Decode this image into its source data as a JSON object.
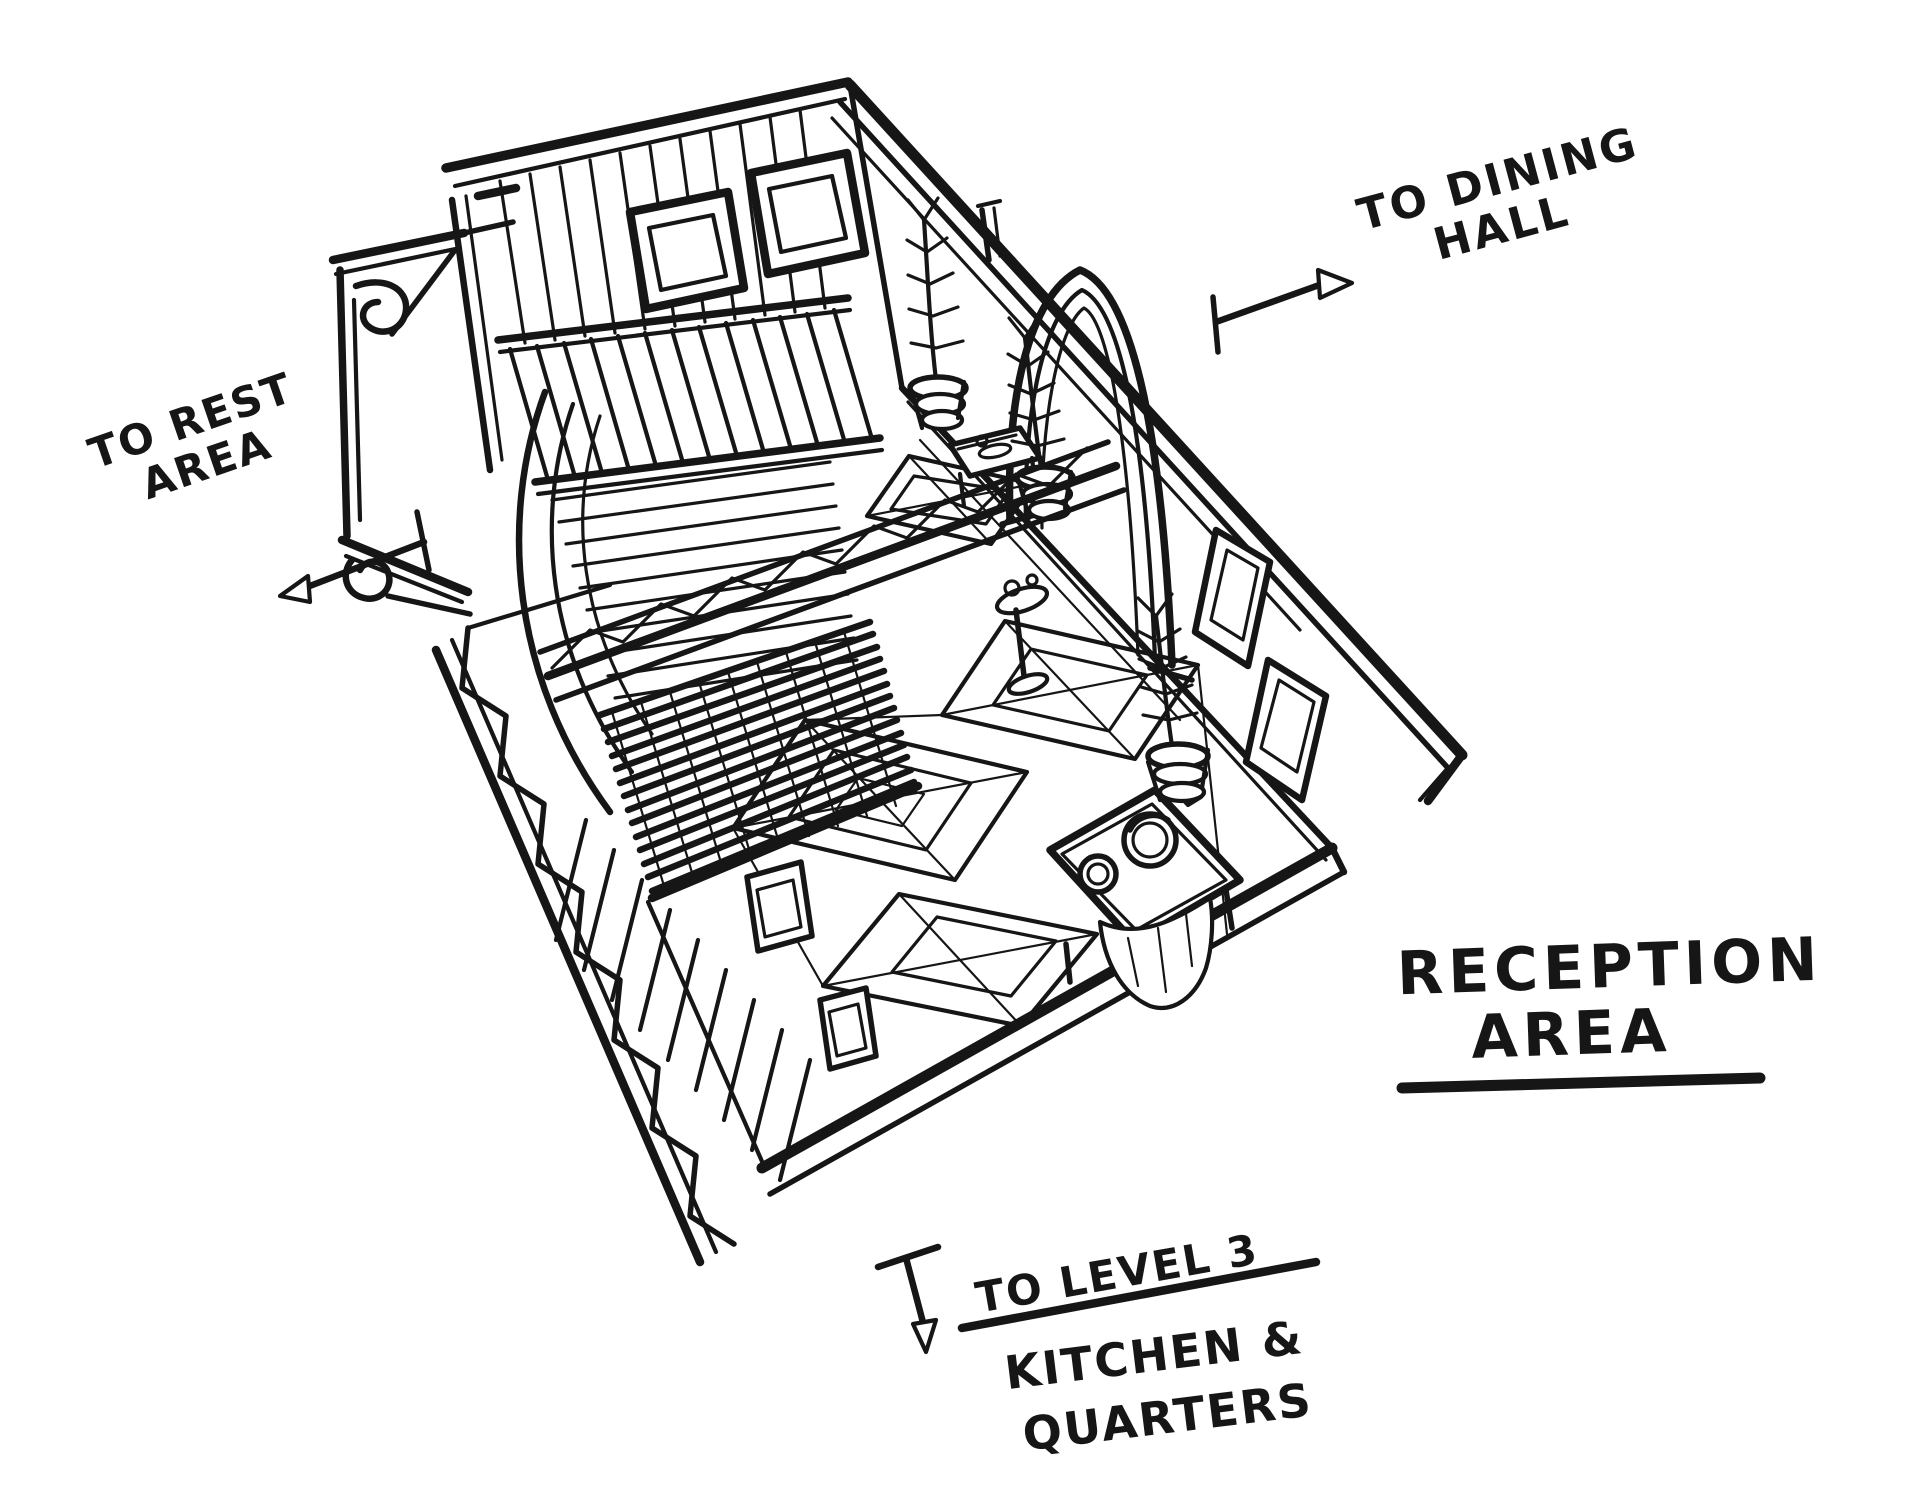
{
  "page": {
    "background": "#ffffff",
    "ink": "#161616"
  },
  "labels": {
    "dining_line1": "TO DINING",
    "dining_line2": "HALL",
    "rest_line1": "TO REST",
    "rest_line2": "AREA",
    "title_line1": "RECEPTION",
    "title_line2": "AREA",
    "level_top": "TO LEVEL 3",
    "level_bottom1": "KITCHEN &",
    "level_bottom2": "QUARTERS"
  },
  "icons": {
    "dining_arrow": "arrow-up-right-icon",
    "rest_arrow": "arrow-down-left-icon",
    "level_arrow": "arrow-down-icon"
  },
  "sketch": {
    "parts": [
      "plank-wall",
      "square-windows",
      "arched-doorway",
      "wall-frames",
      "balcony-railing",
      "vault-arches",
      "truss-railing",
      "slat-grate",
      "scroll-ledge",
      "staircase",
      "diamond-floor-tiles",
      "reception-desk",
      "potted-plants",
      "console-table",
      "pedestal-stand"
    ]
  }
}
